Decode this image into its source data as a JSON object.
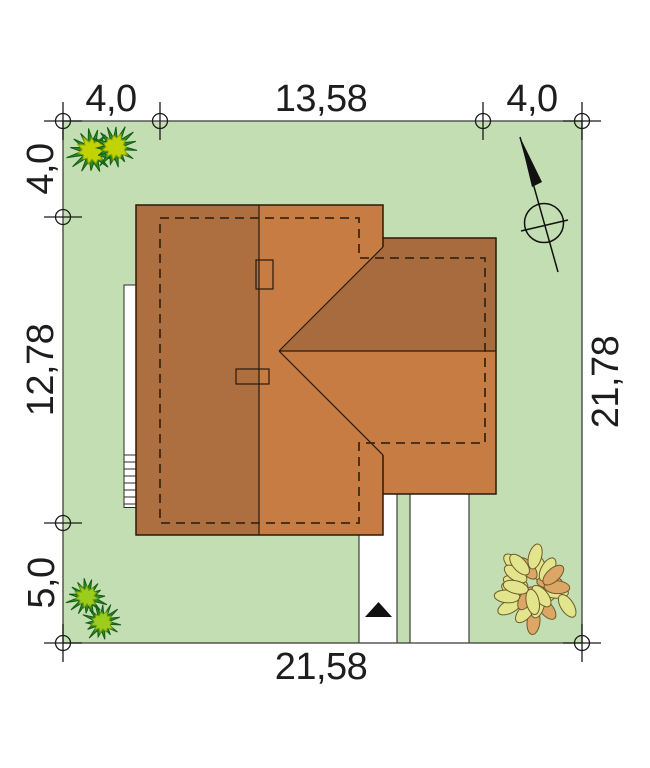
{
  "scene": {
    "background": "#ffffff",
    "plot_fill": "#c3deb2",
    "plot_stroke": "#3f3f3f"
  },
  "dimensions": {
    "top_left": "4,0",
    "top_middle": "13,58",
    "top_right": "4,0",
    "left_top": "4,0",
    "left_middle": "12,78",
    "left_bottom": "5,0",
    "right_side": "21,78",
    "bottom": "21,58"
  },
  "roof": {
    "west_slope": "#ad6e40",
    "east_slope": "#c67c42",
    "wing_north_slope": "#a86b3e",
    "wing_south_slope": "#c67c42",
    "chimney_fill": "#c67c42",
    "outline": "#2a190b",
    "footprint_dash": "#3b2714"
  },
  "driveway": {
    "fill": "#ffffff",
    "stroke": "#2e2e2e",
    "entrance_arrow": "#111111"
  },
  "terrace": {
    "fill": "#ffffff",
    "stroke": "#2b2b2b"
  },
  "plants": {
    "bush_top_left": {
      "clumps": [
        {
          "cx": 92,
          "cy": 151,
          "r": 23
        },
        {
          "cx": 115,
          "cy": 147,
          "r": 21
        }
      ],
      "spike_color": "#2e8b22",
      "spike_dark": "#145c10",
      "core_color": "#c2d303",
      "core_edge": "#86a40c"
    },
    "bush_bottom_left": {
      "clumps": [
        {
          "cx": 87,
          "cy": 597,
          "r": 19
        },
        {
          "cx": 102,
          "cy": 622,
          "r": 18
        }
      ],
      "spike_color": "#2e8b22",
      "spike_dark": "#145c10",
      "core_color": "#9ccc1c",
      "core_edge": "#6f9c10"
    },
    "tree_bottom_right": {
      "cx": 535,
      "cy": 589,
      "r": 40,
      "leaves": 26,
      "leaf_colors": [
        "#e3e58d",
        "#dca766"
      ],
      "leaf_edge": "#6d5b2a"
    }
  }
}
